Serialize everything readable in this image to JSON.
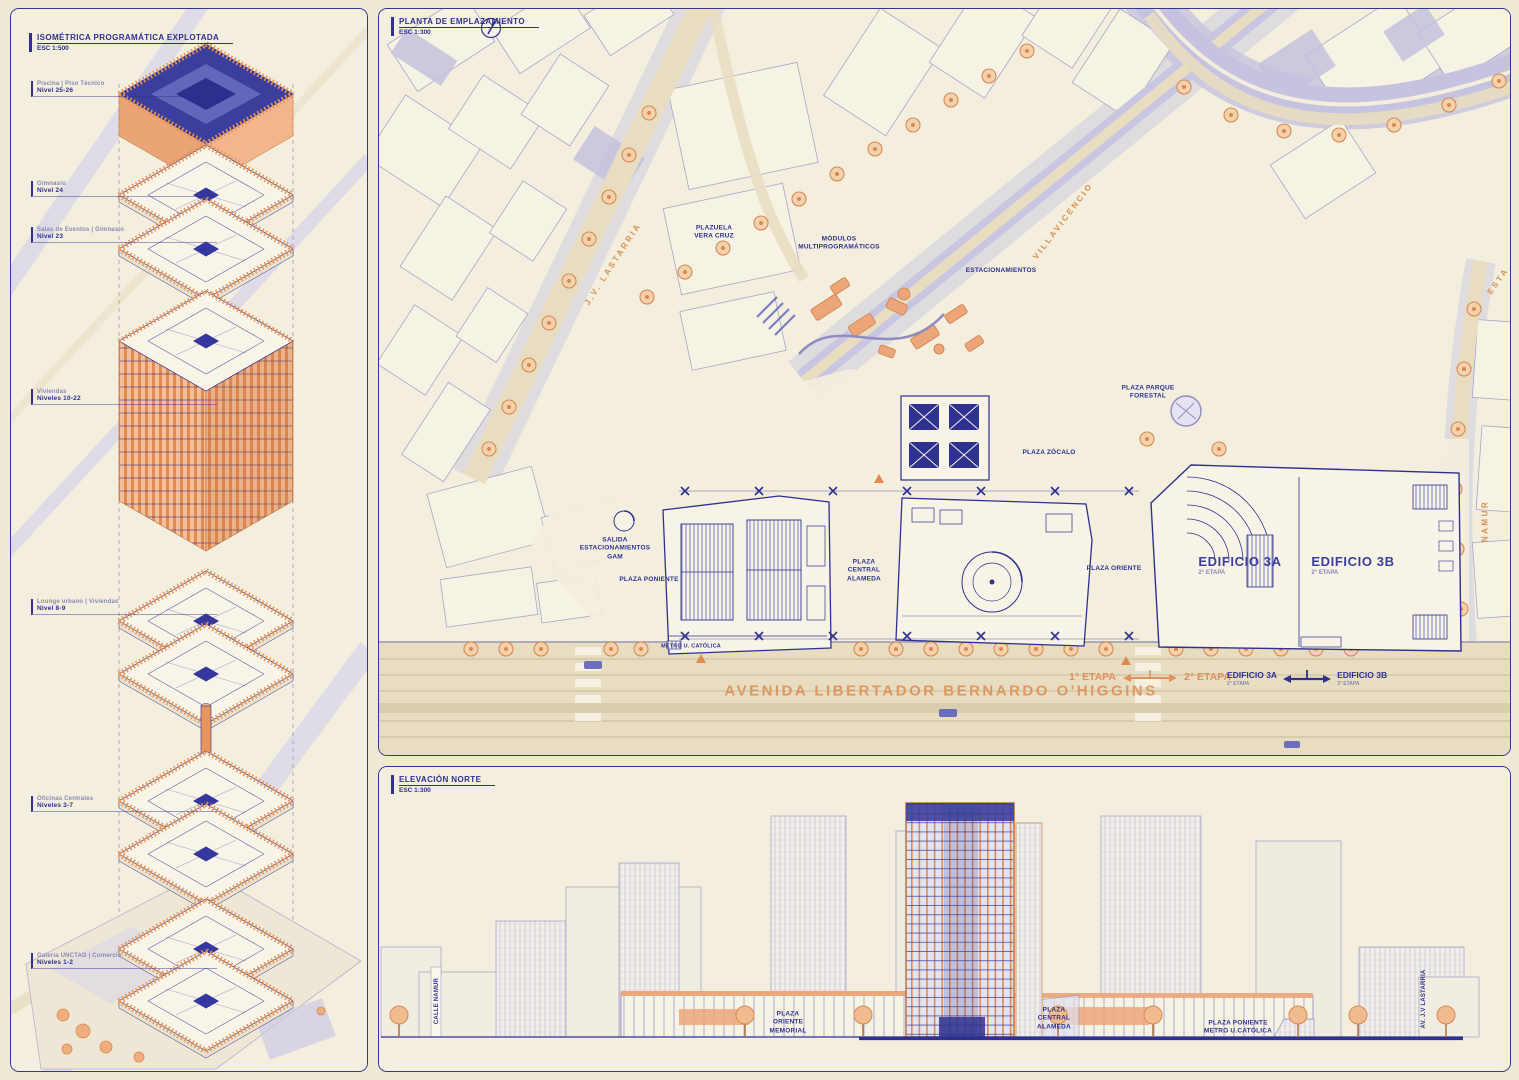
{
  "iso_panel": {
    "title": "ISOMÉTRICA PROGRAMÁTICA EXPLOTADA",
    "scale": "ESC 1:500",
    "levels": [
      {
        "name": "Piscina | Piso Técnico",
        "range": "Nivel 25-26"
      },
      {
        "name": "Gimnasio",
        "range": "Nivel 24"
      },
      {
        "name": "Salas de Eventos | Gimnasio",
        "range": "Nivel 23"
      },
      {
        "name": "Viviendas",
        "range": "Niveles 10-22"
      },
      {
        "name": "Lounge urbano | Viviendas",
        "range": "Nivel 8-9"
      },
      {
        "name": "Oficinas Centrales",
        "range": "Niveles 3-7"
      },
      {
        "name": "Galería UNCTAD | Comercio",
        "range": "Niveles 1-2"
      }
    ]
  },
  "site_panel": {
    "title": "PLANTA DE EMPLAZAMIENTO",
    "scale": "ESC 1:300",
    "streets": {
      "lastarria": "J.V. LASTARRIA",
      "villavicencio": "VILLAVICENCIO",
      "namur": "NAMUR",
      "esta": "ESTA",
      "avenue": "AVENIDA LIBERTADOR BERNARDO O'HIGGINS"
    },
    "places": {
      "plazuela_vera_cruz": "PLAZUELA\nVERA CRUZ",
      "modulos": "MÓDULOS\nMULTIPROGRAMÁTICOS",
      "estacionamientos": "ESTACIONAMIENTOS",
      "plaza_parque_forestal": "PLAZA PARQUE\nFORESTAL",
      "plaza_zocalo": "PLAZA ZÓCALO",
      "salida_estacionamientos": "SALIDA\nESTACIONAMIENTOS\nGAM",
      "plaza_poniente": "PLAZA PONIENTE",
      "plaza_central_alameda": "PLAZA\nCENTRAL\nALAMEDA",
      "plaza_oriente": "PLAZA ORIENTE",
      "metro_u_catolica": "METRO U. CATÓLICA"
    },
    "buildings": {
      "edificio_3a": {
        "name": "EDIFICIO 3A",
        "stage": "2° ETAPA"
      },
      "edificio_3b": {
        "name": "EDIFICIO 3B",
        "stage": "2° ETAPA"
      }
    },
    "legend": {
      "stage1": "1° ETAPA",
      "stage2": "2° ETAPA",
      "ed3a": "EDIFICIO 3A",
      "ed3a_sub": "2° ETAPA",
      "ed3b": "EDIFICIO 3B",
      "ed3b_sub": "3° ETAPA"
    }
  },
  "elevation_panel": {
    "title": "ELEVACIÓN NORTE",
    "scale": "ESC 1:300",
    "labels": {
      "calle_namur": "CALLE NAMUR",
      "plaza_oriente_memorial": "PLAZA\nORIENTE\nMEMORIAL",
      "plaza_central_alameda": "PLAZA\nCENTRAL\nALAMEDA",
      "plaza_poniente_metro": "PLAZA PONIENTE\nMETRO U.CATÓLICA",
      "av_lastarria": "AV. J.V LASTARRIA"
    }
  }
}
